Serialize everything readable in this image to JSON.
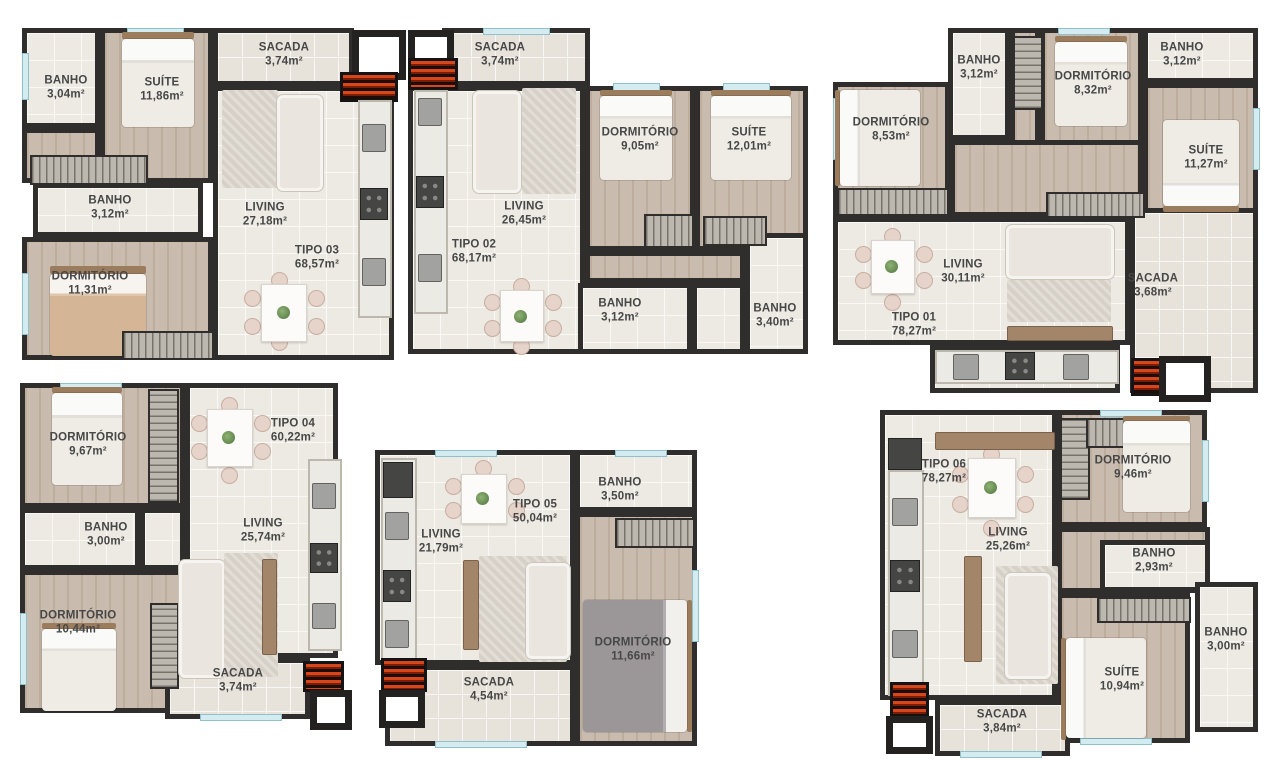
{
  "page": {
    "background": "#ffffff"
  },
  "colors": {
    "wall": "#2f2e2c",
    "tile_floor": "#edeae3",
    "wood_floor": "#c9bcae",
    "balcony_floor": "#e7e3db",
    "label_text": "#474747",
    "window_glass": "#d4ebf0",
    "grill_red": "#d2401c"
  },
  "plans": [
    {
      "id": "tipo-03",
      "title": {
        "name": "TIPO 03",
        "area": "68,57m²"
      },
      "rooms": [
        {
          "name": "BANHO",
          "area": "3,04m²"
        },
        {
          "name": "SUÍTE",
          "area": "11,86m²"
        },
        {
          "name": "SACADA",
          "area": "3,74m²"
        },
        {
          "name": "LIVING",
          "area": "27,18m²"
        },
        {
          "name": "BANHO",
          "area": "3,12m²"
        },
        {
          "name": "DORMITÓRIO",
          "area": "11,31m²"
        }
      ]
    },
    {
      "id": "tipo-02",
      "title": {
        "name": "TIPO 02",
        "area": "68,17m²"
      },
      "rooms": [
        {
          "name": "SACADA",
          "area": "3,74m²"
        },
        {
          "name": "DORMITÓRIO",
          "area": "9,05m²"
        },
        {
          "name": "SUÍTE",
          "area": "12,01m²"
        },
        {
          "name": "LIVING",
          "area": "26,45m²"
        },
        {
          "name": "BANHO",
          "area": "3,12m²"
        },
        {
          "name": "BANHO",
          "area": "3,40m²"
        }
      ]
    },
    {
      "id": "tipo-01",
      "title": {
        "name": "TIPO 01",
        "area": "78,27m²"
      },
      "rooms": [
        {
          "name": "BANHO",
          "area": "3,12m²"
        },
        {
          "name": "DORMITÓRIO",
          "area": "8,32m²"
        },
        {
          "name": "BANHO",
          "area": "3,12m²"
        },
        {
          "name": "DORMITÓRIO",
          "area": "8,53m²"
        },
        {
          "name": "SUÍTE",
          "area": "11,27m²"
        },
        {
          "name": "LIVING",
          "area": "30,11m²"
        },
        {
          "name": "SACADA",
          "area": "3,68m²"
        }
      ]
    },
    {
      "id": "tipo-04",
      "title": {
        "name": "TIPO 04",
        "area": "60,22m²"
      },
      "rooms": [
        {
          "name": "DORMITÓRIO",
          "area": "9,67m²"
        },
        {
          "name": "BANHO",
          "area": "3,00m²"
        },
        {
          "name": "DORMITÓRIO",
          "area": "10,44m²"
        },
        {
          "name": "LIVING",
          "area": "25,74m²"
        },
        {
          "name": "SACADA",
          "area": "3,74m²"
        }
      ]
    },
    {
      "id": "tipo-05",
      "title": {
        "name": "TIPO 05",
        "area": "50,04m²"
      },
      "rooms": [
        {
          "name": "BANHO",
          "area": "3,50m²"
        },
        {
          "name": "LIVING",
          "area": "21,79m²"
        },
        {
          "name": "DORMITÓRIO",
          "area": "11,66m²"
        },
        {
          "name": "SACADA",
          "area": "4,54m²"
        }
      ]
    },
    {
      "id": "tipo-06",
      "title": {
        "name": "TIPO 06",
        "area": "78,27m²"
      },
      "rooms": [
        {
          "name": "DORMITÓRIO",
          "area": "9,46m²"
        },
        {
          "name": "LIVING",
          "area": "25,26m²"
        },
        {
          "name": "BANHO",
          "area": "2,93m²"
        },
        {
          "name": "BANHO",
          "area": "3,00m²"
        },
        {
          "name": "SUÍTE",
          "area": "10,94m²"
        },
        {
          "name": "SACADA",
          "area": "3,84m²"
        }
      ]
    }
  ]
}
